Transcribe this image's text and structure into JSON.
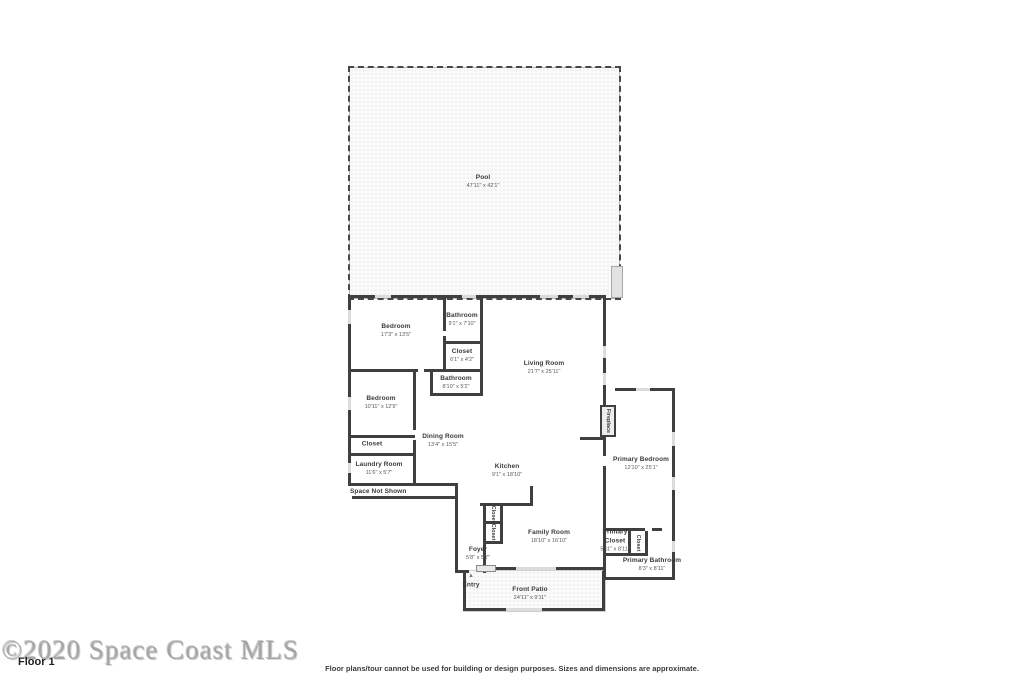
{
  "rooms": {
    "pool": {
      "name": "Pool",
      "dims": "47'11\" x 42'1\""
    },
    "bedroom_top": {
      "name": "Bedroom",
      "dims": "17'3\" x 13'5\""
    },
    "bathroom_top": {
      "name": "Bathroom",
      "dims": "9'1\" x 7'10\""
    },
    "closet_hall": {
      "name": "Closet",
      "dims": "6'1\" x 4'2\""
    },
    "bathroom_mid": {
      "name": "Bathroom",
      "dims": "8'10\" x 5'2\""
    },
    "bedroom_left": {
      "name": "Bedroom",
      "dims": "10'11\" x 12'9\""
    },
    "closet_bedroom": {
      "name": "Closet"
    },
    "laundry": {
      "name": "Laundry Room",
      "dims": "11'6\" x 5'7\""
    },
    "space_not_shown": {
      "name": "Space Not Shown"
    },
    "living": {
      "name": "Living Room",
      "dims": "21'7\" x 25'11\""
    },
    "dining": {
      "name": "Dining Room",
      "dims": "13'4\" x 15'5\""
    },
    "kitchen": {
      "name": "Kitchen",
      "dims": "9'1\" x 18'10\""
    },
    "family": {
      "name": "Family Room",
      "dims": "18'10\" x 16'10\""
    },
    "foyer": {
      "name": "Foyer",
      "dims": "5'8\" x 5'7\""
    },
    "entry": {
      "name": "Entry"
    },
    "front_patio": {
      "name": "Front Patio",
      "dims": "24'11\" x 9'11\""
    },
    "primary_bedroom": {
      "name": "Primary Bedroom",
      "dims": "12'10\" x 25'1\""
    },
    "primary_closet": {
      "name": "Primary Closet",
      "dims": "5'11\" x 8'11\""
    },
    "primary_bathroom": {
      "name": "Primary Bathroom",
      "dims": "8'3\" x 8'11\""
    },
    "fireplace": {
      "name": "Fireplace"
    },
    "closet_kitchen_1": {
      "name": "Closet"
    },
    "closet_kitchen_2": {
      "name": "Closet"
    },
    "closet_primary": {
      "name": "Closet"
    }
  },
  "icons": {
    "entry_arrow": "▲"
  },
  "footer": {
    "watermark": "©2020 Space Coast MLS",
    "floor_label": "Floor 1",
    "disclaimer": "Floor plans/tour cannot be used for building or design purposes. Sizes and dimensions are approximate."
  },
  "colors": {
    "wall": "#3f3f3f",
    "label": "#3a3a3a",
    "texture_dot": "#d9d9d9",
    "watermark": "#8f8f8f"
  }
}
